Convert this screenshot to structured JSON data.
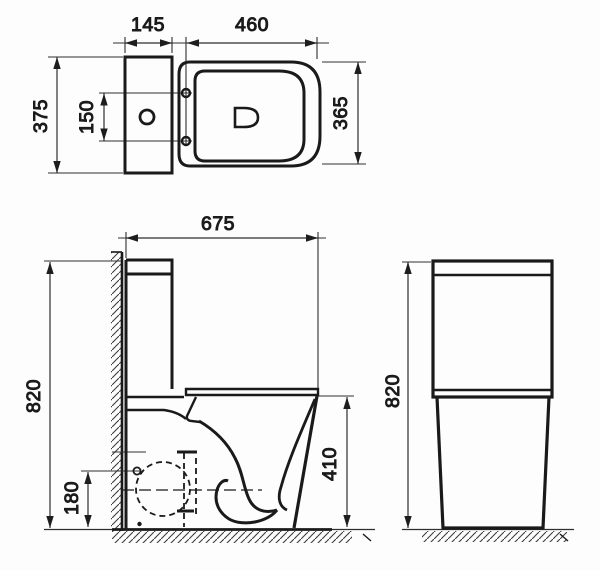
{
  "drawing": {
    "type": "technical-dimension-drawing",
    "subject": "close-coupled toilet, three orthographic views",
    "colors": {
      "line": "#1a1a1a",
      "dim": "#2e2e2e",
      "background": "#fdfdfd"
    },
    "views": {
      "top_view": {
        "label": "top view",
        "dimensions": {
          "tank_depth": "145",
          "seat_length": "460",
          "overall_width": "375",
          "fixing_holes_spacing": "150",
          "bowl_width": "365"
        }
      },
      "side_view": {
        "label": "side view",
        "dimensions": {
          "overall_depth": "675",
          "overall_height": "820",
          "outlet_height": "180",
          "rim_height": "410"
        }
      },
      "front_view": {
        "label": "front view",
        "dimensions": {
          "overall_height": "820"
        }
      }
    }
  }
}
